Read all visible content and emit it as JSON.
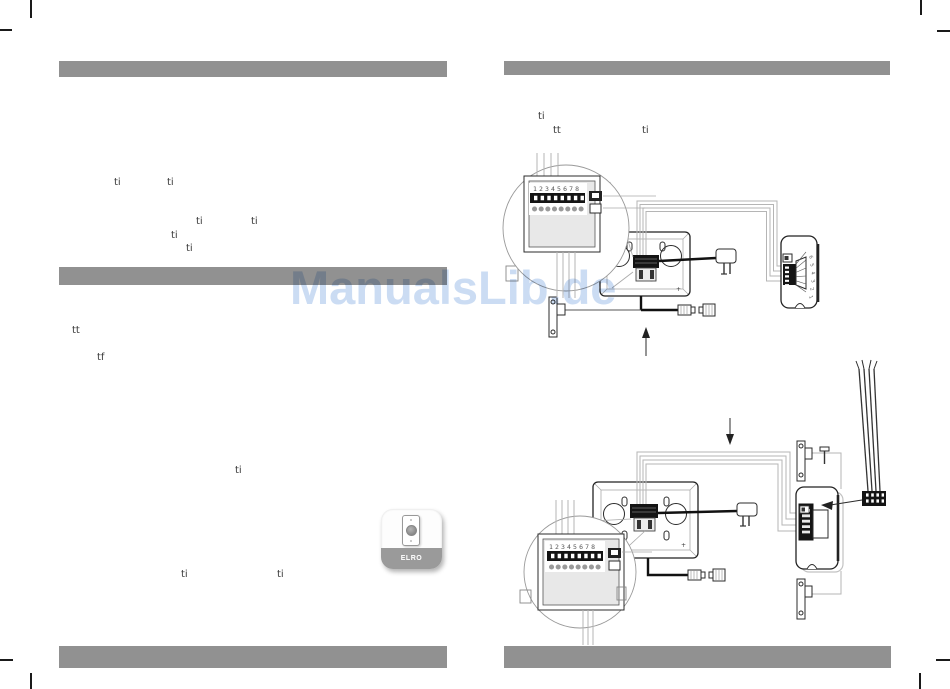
{
  "watermark": {
    "text": "ManualsLib.de",
    "color": "#c8daf3"
  },
  "colors": {
    "bar": "#919191",
    "wire_gray": "#b5b5b5",
    "line": "#1a1a1a"
  },
  "left_page": {
    "fragments": [
      {
        "t": "ti"
      },
      {
        "t": "ti"
      },
      {
        "t": "ti"
      },
      {
        "t": "ti"
      },
      {
        "t": "ti"
      },
      {
        "t": "ti"
      },
      {
        "t": "tt"
      },
      {
        "t": "tf"
      },
      {
        "t": "ti"
      },
      {
        "t": "ti"
      },
      {
        "t": "ti"
      }
    ]
  },
  "right_page": {
    "fragments": [
      {
        "t": "ti"
      },
      {
        "t": "tt"
      },
      {
        "t": "ti"
      }
    ]
  },
  "device": {
    "brand": "ELRO"
  },
  "diagram_top": {
    "terminals": "12345678",
    "plus": "+",
    "pins": [
      "6",
      "5",
      "4",
      "3",
      "2",
      "1"
    ]
  },
  "diagram_bottom": {
    "terminals": "12345678",
    "plus": "+"
  }
}
